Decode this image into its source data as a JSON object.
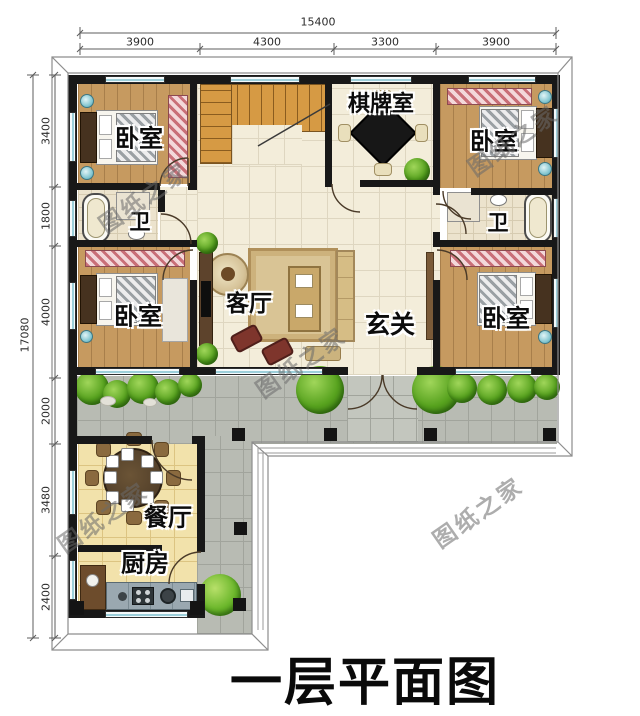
{
  "title": "一层平面图",
  "watermark": {
    "text": "图纸之家"
  },
  "dimensions": {
    "top": {
      "total": "15400",
      "segments": [
        "3900",
        "4300",
        "3300",
        "3900"
      ]
    },
    "left": {
      "total": "17080",
      "segments": [
        "3400",
        "1800",
        "4000",
        "2000",
        "3480",
        "2400"
      ]
    }
  },
  "rooms": {
    "bedroom_top_left": {
      "label": "卧室"
    },
    "bedroom_top_right": {
      "label": "卧室"
    },
    "bedroom_mid_left": {
      "label": "卧室"
    },
    "bedroom_mid_right": {
      "label": "卧室"
    },
    "chess_room": {
      "label": "棋牌室"
    },
    "bathroom_left": {
      "label": "卫"
    },
    "bathroom_right": {
      "label": "卫"
    },
    "living_room": {
      "label": "客厅"
    },
    "foyer": {
      "label": "玄关"
    },
    "dining_room": {
      "label": "餐厅"
    },
    "kitchen": {
      "label": "厨房"
    }
  },
  "colors": {
    "wall": "#181818",
    "wood_floor": "#c69a60",
    "tile_floor": "#f3edda",
    "warm_floor": "#f2e2ab",
    "terrace": "#b8bbb3",
    "shrub_green": "#57a21e",
    "window_blue": "#9ccfda",
    "wardrobe_pink": "#c96f78",
    "title_text": "#0a0a0a",
    "dimension_text": "#2c2c2c",
    "watermark_gray": "#696969"
  }
}
